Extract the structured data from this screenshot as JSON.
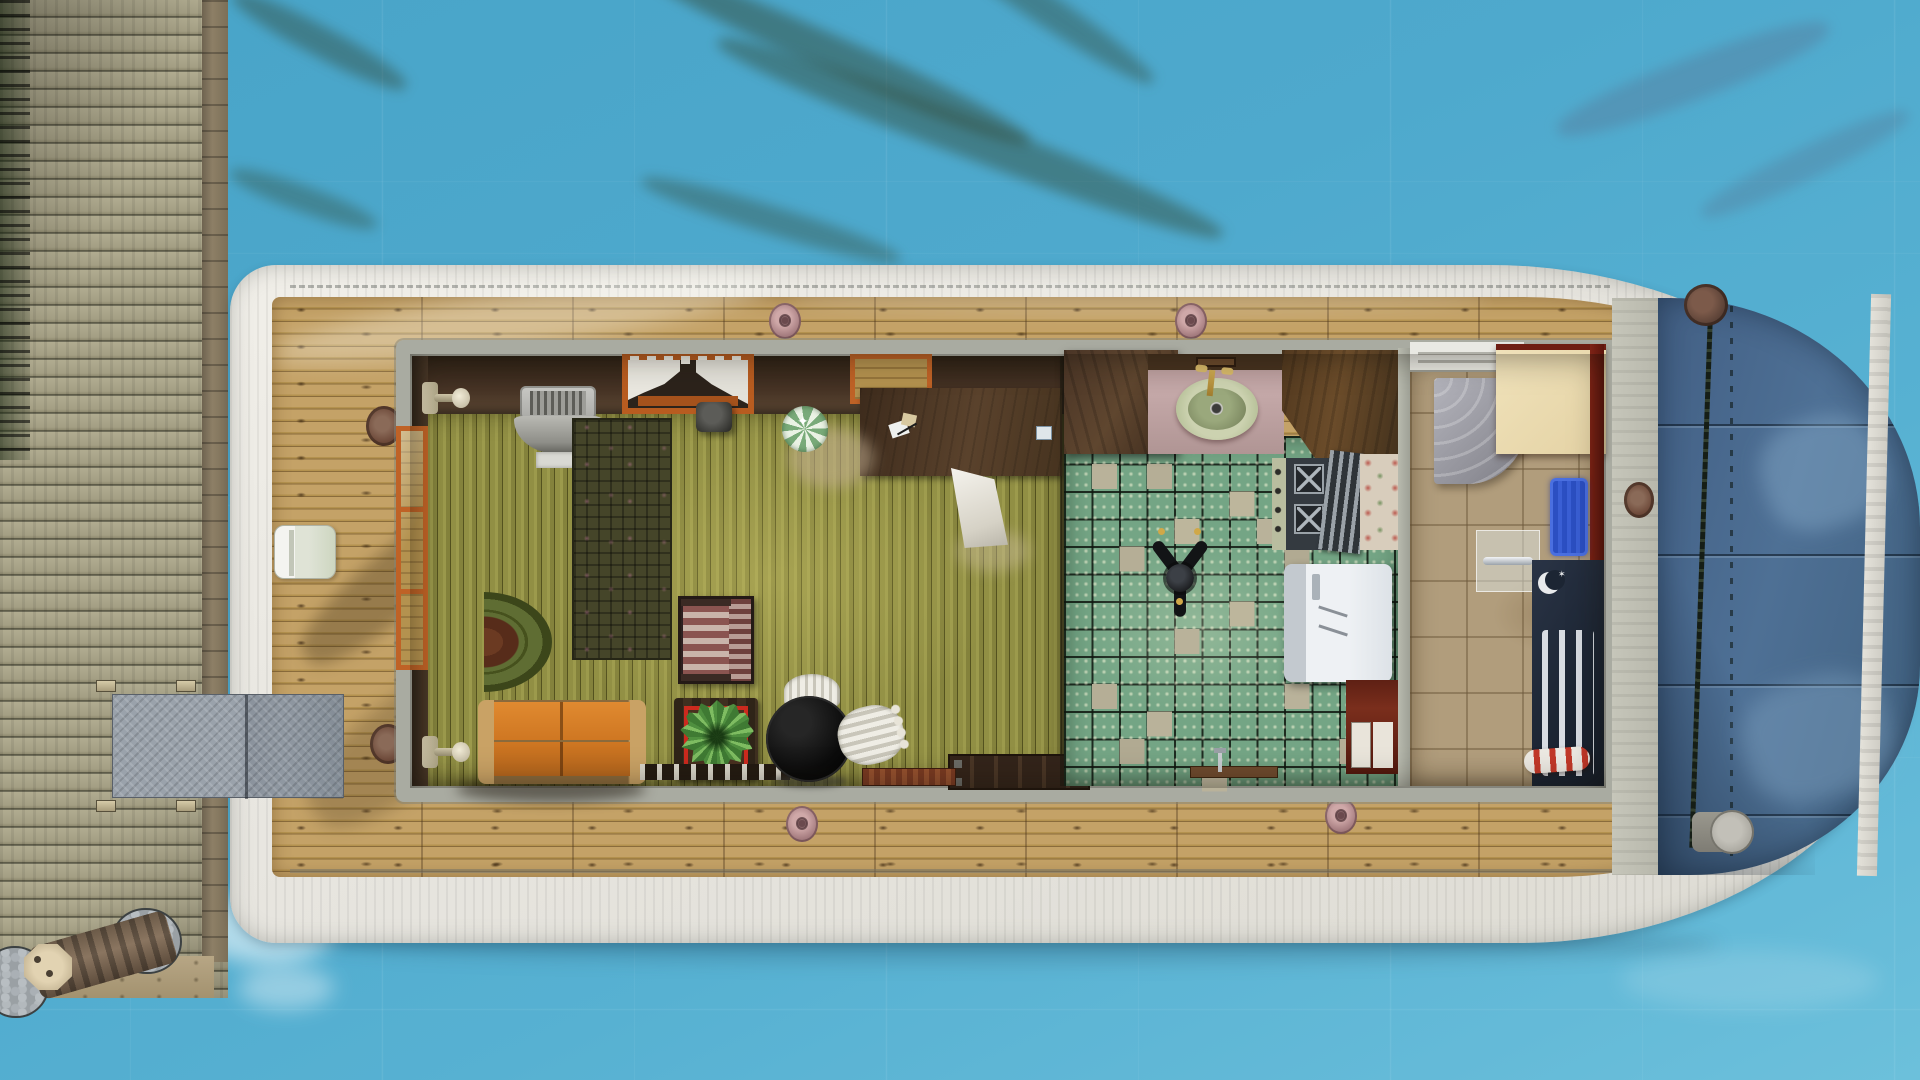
{
  "scene": {
    "view": "top-down aerial",
    "setting": "houseboat moored beside a weathered wooden pier on open water",
    "style": "life-simulation game screenshot"
  },
  "palette": {
    "water": "#4fa8cb",
    "dock_wood": "#a9a489",
    "hull_white": "#e9e7e1",
    "deck_wood": "#bd9c62",
    "cabin_wall": "#a9aba1",
    "living_floor_olive": "#8f8d42",
    "kitchen_tile_green": "#74a585",
    "kitchen_tile_tan": "#b9b29a",
    "bath_tile_tan": "#b19d7c",
    "bow_glass_blue": "#4e7095",
    "couch_orange": "#d97f2a",
    "window_frame_orange": "#bf6226",
    "bath_wall_maroon": "#6e1d12",
    "bath_mat_blue": "#2b4fc2"
  },
  "objects": {
    "dock": {
      "label": "wooden pier"
    },
    "piling": {
      "label": "mooring piling with stone base"
    },
    "gangplank": {
      "label": "metal boarding ramp"
    },
    "hull": {
      "label": "white houseboat hull"
    },
    "deck": {
      "label": "wooden deck"
    },
    "cleat": {
      "label": "deck cleat"
    },
    "cooler": {
      "label": "deck cooler box"
    },
    "bow_glass": {
      "label": "glass bow canopy"
    },
    "rope": {
      "label": "mooring line with capstans"
    },
    "sconce": {
      "label": "wall lamp"
    },
    "tv": {
      "label": "wall-mounted television"
    },
    "curtain_window": {
      "label": "curtained window"
    },
    "window": {
      "label": "window"
    },
    "desk": {
      "label": "writing desk with papers"
    },
    "trash_bin": {
      "label": "waste bin"
    },
    "floor_lamp": {
      "label": "striped floor lamp"
    },
    "pendant_lamp": {
      "label": "hanging cone lamp"
    },
    "plaid_rug": {
      "label": "plaid area rug"
    },
    "half_rug": {
      "label": "semicircle rug"
    },
    "armchair": {
      "label": "striped armchair"
    },
    "couch": {
      "label": "orange loveseat"
    },
    "side_table": {
      "label": "side table"
    },
    "plant": {
      "label": "potted agave plant"
    },
    "dining_table": {
      "label": "round black table"
    },
    "stool": {
      "label": "white drum stool"
    },
    "bench": {
      "label": "storage bench"
    },
    "heater": {
      "label": "baseboard heater"
    },
    "counter": {
      "label": "kitchen counter"
    },
    "sink": {
      "label": "kitchen sink"
    },
    "stove": {
      "label": "stove cooktop"
    },
    "grill_rack": {
      "label": "oven rack"
    },
    "fridge": {
      "label": "refrigerator"
    },
    "cabinet": {
      "label": "kitchen cabinet"
    },
    "ceiling_fan": {
      "label": "ceiling fan"
    },
    "shower": {
      "label": "shower stall"
    },
    "bath_counter": {
      "label": "bathroom counter"
    },
    "glass_door": {
      "label": "glass shower door"
    },
    "bath_mat": {
      "label": "blue bath mat"
    },
    "radiator": {
      "label": "wall radiator panel"
    },
    "towel": {
      "label": "rolled striped towel"
    }
  }
}
